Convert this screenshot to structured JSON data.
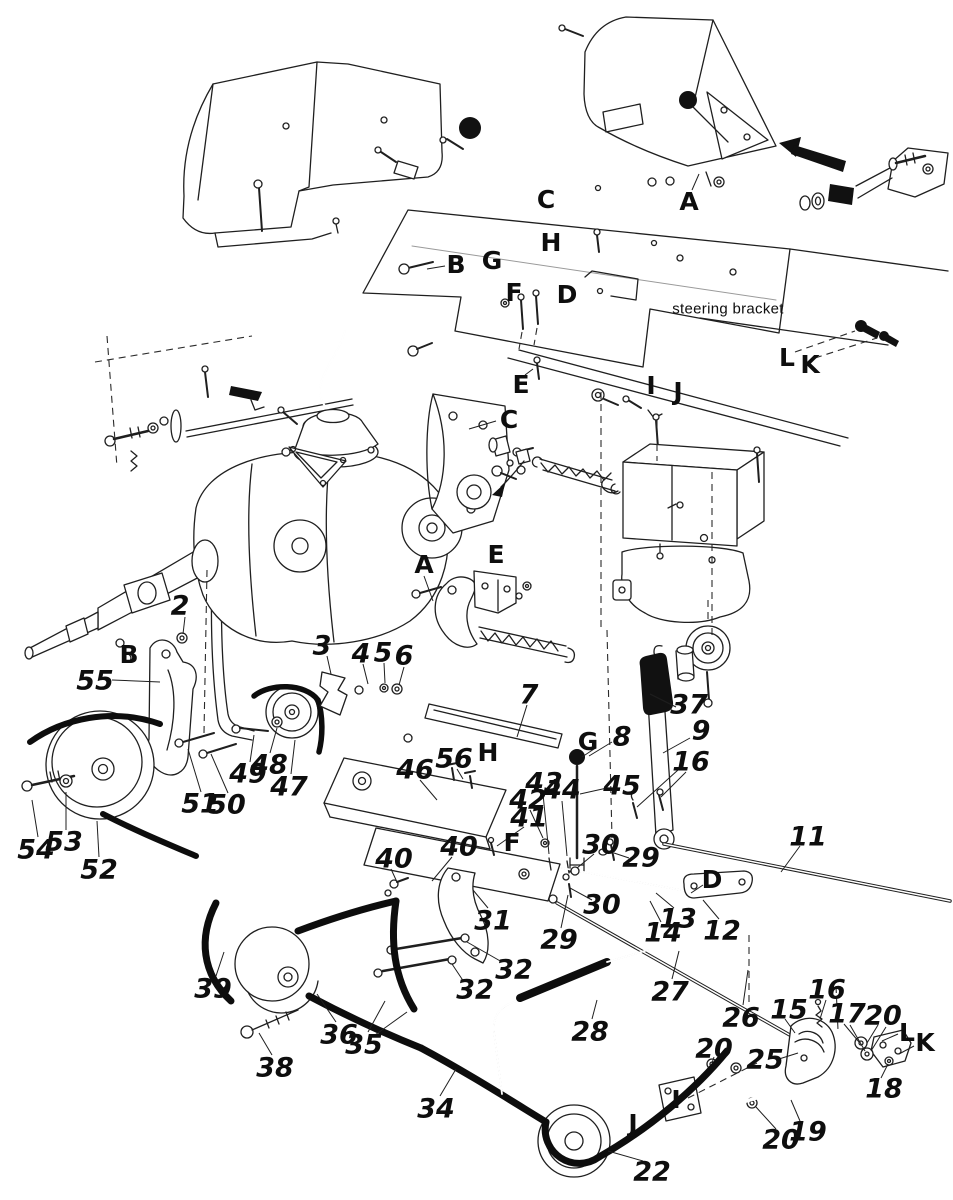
{
  "colors": {
    "ink": "#1f1f1f",
    "paper": "#ffffff",
    "solid_black": "#111111"
  },
  "note": {
    "steering_bracket": "steering bracket"
  },
  "labels": [
    {
      "id": "note-steering-bracket",
      "t": "steering bracket",
      "x": 728,
      "y": 308,
      "k": "note"
    },
    {
      "id": "ref-C-top",
      "t": "C",
      "x": 546,
      "y": 199,
      "k": "cap"
    },
    {
      "id": "ref-A-top",
      "t": "A",
      "x": 689,
      "y": 201,
      "k": "cap"
    },
    {
      "id": "ref-H-top",
      "t": "H",
      "x": 551,
      "y": 242,
      "k": "cap"
    },
    {
      "id": "ref-B-top",
      "t": "B",
      "x": 456,
      "y": 264,
      "k": "cap"
    },
    {
      "id": "ref-G-top",
      "t": "G",
      "x": 492,
      "y": 260,
      "k": "cap"
    },
    {
      "id": "ref-F-top",
      "t": "F",
      "x": 514,
      "y": 292,
      "k": "cap"
    },
    {
      "id": "ref-D-top",
      "t": "D",
      "x": 567,
      "y": 294,
      "k": "cap"
    },
    {
      "id": "ref-L-top",
      "t": "L",
      "x": 787,
      "y": 357,
      "k": "cap"
    },
    {
      "id": "ref-K-top",
      "t": "K",
      "x": 810,
      "y": 364,
      "k": "cap"
    },
    {
      "id": "ref-E-top",
      "t": "E",
      "x": 521,
      "y": 384,
      "k": "cap"
    },
    {
      "id": "ref-I-top",
      "t": "I",
      "x": 651,
      "y": 385,
      "k": "cap"
    },
    {
      "id": "ref-J-top",
      "t": "J",
      "x": 678,
      "y": 391,
      "k": "cap"
    },
    {
      "id": "ref-C-mid",
      "t": "C",
      "x": 509,
      "y": 419,
      "k": "cap"
    },
    {
      "id": "ref-E-mid",
      "t": "E",
      "x": 496,
      "y": 554,
      "k": "cap"
    },
    {
      "id": "ref-A-mid",
      "t": "A",
      "x": 424,
      "y": 564,
      "k": "cap"
    },
    {
      "id": "ref-B-left",
      "t": "B",
      "x": 129,
      "y": 654,
      "k": "cap"
    },
    {
      "id": "ref-G-mid",
      "t": "G",
      "x": 588,
      "y": 741,
      "k": "cap"
    },
    {
      "id": "ref-H-mid",
      "t": "H",
      "x": 488,
      "y": 752,
      "k": "cap"
    },
    {
      "id": "ref-F-mid",
      "t": "F",
      "x": 512,
      "y": 842,
      "k": "cap"
    },
    {
      "id": "ref-D-mid",
      "t": "D",
      "x": 712,
      "y": 879,
      "k": "cap"
    },
    {
      "id": "ref-L-bot",
      "t": "L",
      "x": 907,
      "y": 1032,
      "k": "cap"
    },
    {
      "id": "ref-K-bot",
      "t": "K",
      "x": 925,
      "y": 1042,
      "k": "cap"
    },
    {
      "id": "ref-I-bot",
      "t": "I",
      "x": 676,
      "y": 1099,
      "k": "cap"
    },
    {
      "id": "ref-J-bot",
      "t": "J",
      "x": 633,
      "y": 1123,
      "k": "cap"
    },
    {
      "id": "part-2",
      "t": "2",
      "x": 180,
      "y": 605,
      "k": "num"
    },
    {
      "id": "part-3",
      "t": "3",
      "x": 322,
      "y": 645,
      "k": "num"
    },
    {
      "id": "part-4",
      "t": "4",
      "x": 361,
      "y": 653,
      "k": "num"
    },
    {
      "id": "part-5",
      "t": "5",
      "x": 383,
      "y": 652,
      "k": "num"
    },
    {
      "id": "part-6",
      "t": "6",
      "x": 404,
      "y": 655,
      "k": "num"
    },
    {
      "id": "part-7",
      "t": "7",
      "x": 529,
      "y": 694,
      "k": "num"
    },
    {
      "id": "part-8",
      "t": "8",
      "x": 622,
      "y": 736,
      "k": "num"
    },
    {
      "id": "part-9",
      "t": "9",
      "x": 701,
      "y": 730,
      "k": "num"
    },
    {
      "id": "part-11",
      "t": "11",
      "x": 808,
      "y": 836,
      "k": "num"
    },
    {
      "id": "part-12",
      "t": "12",
      "x": 722,
      "y": 930,
      "k": "num"
    },
    {
      "id": "part-13",
      "t": "13",
      "x": 678,
      "y": 918,
      "k": "num"
    },
    {
      "id": "part-14",
      "t": "14",
      "x": 663,
      "y": 932,
      "k": "num"
    },
    {
      "id": "part-15",
      "t": "15",
      "x": 789,
      "y": 1009,
      "k": "num"
    },
    {
      "id": "part-16a",
      "t": "16",
      "x": 691,
      "y": 761,
      "k": "num"
    },
    {
      "id": "part-16b",
      "t": "16",
      "x": 827,
      "y": 989,
      "k": "num"
    },
    {
      "id": "part-17",
      "t": "17",
      "x": 847,
      "y": 1013,
      "k": "num"
    },
    {
      "id": "part-18",
      "t": "18",
      "x": 884,
      "y": 1088,
      "k": "num"
    },
    {
      "id": "part-19",
      "t": "19",
      "x": 808,
      "y": 1131,
      "k": "num"
    },
    {
      "id": "part-20a",
      "t": "20",
      "x": 883,
      "y": 1015,
      "k": "num"
    },
    {
      "id": "part-20b",
      "t": "20",
      "x": 714,
      "y": 1048,
      "k": "num"
    },
    {
      "id": "part-20c",
      "t": "20",
      "x": 781,
      "y": 1139,
      "k": "num"
    },
    {
      "id": "part-22",
      "t": "22",
      "x": 652,
      "y": 1171,
      "k": "num"
    },
    {
      "id": "part-25",
      "t": "25",
      "x": 765,
      "y": 1059,
      "k": "num"
    },
    {
      "id": "part-26",
      "t": "26",
      "x": 741,
      "y": 1017,
      "k": "num"
    },
    {
      "id": "part-27",
      "t": "27",
      "x": 670,
      "y": 991,
      "k": "num"
    },
    {
      "id": "part-28",
      "t": "28",
      "x": 590,
      "y": 1031,
      "k": "num"
    },
    {
      "id": "part-29a",
      "t": "29",
      "x": 641,
      "y": 857,
      "k": "num"
    },
    {
      "id": "part-29b",
      "t": "29",
      "x": 559,
      "y": 939,
      "k": "num"
    },
    {
      "id": "part-30a",
      "t": "30",
      "x": 601,
      "y": 844,
      "k": "num"
    },
    {
      "id": "part-30b",
      "t": "30",
      "x": 602,
      "y": 904,
      "k": "num"
    },
    {
      "id": "part-31",
      "t": "31",
      "x": 493,
      "y": 920,
      "k": "num"
    },
    {
      "id": "part-32a",
      "t": "32",
      "x": 514,
      "y": 969,
      "k": "num"
    },
    {
      "id": "part-32b",
      "t": "32",
      "x": 475,
      "y": 989,
      "k": "num"
    },
    {
      "id": "part-34",
      "t": "34",
      "x": 436,
      "y": 1108,
      "k": "num"
    },
    {
      "id": "part-35",
      "t": "35",
      "x": 364,
      "y": 1044,
      "k": "num"
    },
    {
      "id": "part-36",
      "t": "36",
      "x": 339,
      "y": 1034,
      "k": "num"
    },
    {
      "id": "part-37",
      "t": "37",
      "x": 689,
      "y": 704,
      "k": "num"
    },
    {
      "id": "part-38",
      "t": "38",
      "x": 275,
      "y": 1067,
      "k": "num"
    },
    {
      "id": "part-39",
      "t": "39",
      "x": 213,
      "y": 988,
      "k": "num"
    },
    {
      "id": "part-40a",
      "t": "40",
      "x": 459,
      "y": 846,
      "k": "num"
    },
    {
      "id": "part-40b",
      "t": "40",
      "x": 394,
      "y": 858,
      "k": "num"
    },
    {
      "id": "part-41",
      "t": "41",
      "x": 529,
      "y": 817,
      "k": "num"
    },
    {
      "id": "part-42",
      "t": "42",
      "x": 528,
      "y": 799,
      "k": "num"
    },
    {
      "id": "part-43",
      "t": "43",
      "x": 544,
      "y": 782,
      "k": "num"
    },
    {
      "id": "part-44",
      "t": "44",
      "x": 562,
      "y": 789,
      "k": "num"
    },
    {
      "id": "part-45",
      "t": "45",
      "x": 622,
      "y": 785,
      "k": "num"
    },
    {
      "id": "part-46",
      "t": "46",
      "x": 415,
      "y": 769,
      "k": "num"
    },
    {
      "id": "part-47",
      "t": "47",
      "x": 289,
      "y": 786,
      "k": "num"
    },
    {
      "id": "part-48",
      "t": "48",
      "x": 269,
      "y": 764,
      "k": "num"
    },
    {
      "id": "part-49",
      "t": "49",
      "x": 248,
      "y": 773,
      "k": "num"
    },
    {
      "id": "part-50",
      "t": "50",
      "x": 227,
      "y": 804,
      "k": "num"
    },
    {
      "id": "part-51",
      "t": "51",
      "x": 200,
      "y": 803,
      "k": "num"
    },
    {
      "id": "part-52",
      "t": "52",
      "x": 99,
      "y": 869,
      "k": "num"
    },
    {
      "id": "part-53",
      "t": "53",
      "x": 64,
      "y": 841,
      "k": "num"
    },
    {
      "id": "part-54",
      "t": "54",
      "x": 36,
      "y": 849,
      "k": "num"
    },
    {
      "id": "part-55",
      "t": "55",
      "x": 95,
      "y": 680,
      "k": "num"
    },
    {
      "id": "part-56",
      "t": "56",
      "x": 454,
      "y": 758,
      "k": "num"
    }
  ],
  "leaders": [
    [
      112,
      680,
      160,
      682
    ],
    [
      185,
      617,
      183,
      634
    ],
    [
      327,
      656,
      331,
      674
    ],
    [
      363,
      664,
      368,
      684
    ],
    [
      384,
      663,
      385,
      683
    ],
    [
      404,
      667,
      399,
      685
    ],
    [
      527,
      705,
      517,
      737
    ],
    [
      612,
      742,
      589,
      756
    ],
    [
      594,
      749,
      582,
      757
    ],
    [
      690,
      738,
      663,
      753
    ],
    [
      676,
      707,
      650,
      694
    ],
    [
      678,
      770,
      637,
      807
    ],
    [
      686,
      772,
      661,
      797
    ],
    [
      607,
      788,
      580,
      794
    ],
    [
      543,
      794,
      549,
      854
    ],
    [
      562,
      801,
      567,
      856
    ],
    [
      530,
      810,
      543,
      838
    ],
    [
      524,
      827,
      497,
      846
    ],
    [
      452,
      857,
      432,
      881
    ],
    [
      391,
      869,
      397,
      882
    ],
    [
      420,
      780,
      437,
      800
    ],
    [
      457,
      769,
      463,
      779
    ],
    [
      291,
      774,
      295,
      740
    ],
    [
      270,
      753,
      277,
      728
    ],
    [
      250,
      762,
      254,
      735
    ],
    [
      228,
      793,
      211,
      754
    ],
    [
      201,
      792,
      188,
      749
    ],
    [
      99,
      857,
      97,
      821
    ],
    [
      66,
      830,
      66,
      792
    ],
    [
      38,
      837,
      32,
      800
    ],
    [
      272,
      1055,
      259,
      1033
    ],
    [
      216,
      976,
      224,
      952
    ],
    [
      336,
      1022,
      317,
      994
    ],
    [
      368,
      1032,
      385,
      1001
    ],
    [
      375,
      1035,
      407,
      1012
    ],
    [
      440,
      1096,
      456,
      1069
    ],
    [
      643,
      1161,
      608,
      1151
    ],
    [
      592,
      1019,
      597,
      1000
    ],
    [
      672,
      979,
      679,
      951
    ],
    [
      743,
      1005,
      748,
      970
    ],
    [
      488,
      908,
      473,
      890
    ],
    [
      502,
      962,
      467,
      942
    ],
    [
      464,
      982,
      452,
      964
    ],
    [
      594,
      854,
      577,
      868
    ],
    [
      592,
      900,
      570,
      888
    ],
    [
      629,
      858,
      614,
      853
    ],
    [
      561,
      928,
      568,
      895
    ],
    [
      661,
      922,
      650,
      901
    ],
    [
      674,
      908,
      656,
      893
    ],
    [
      719,
      919,
      703,
      900
    ],
    [
      703,
      885,
      691,
      893
    ],
    [
      800,
      846,
      781,
      872
    ],
    [
      785,
      1019,
      795,
      1033
    ],
    [
      826,
      1000,
      820,
      1019
    ],
    [
      844,
      1024,
      859,
      1042
    ],
    [
      850,
      1025,
      865,
      1051
    ],
    [
      878,
      1025,
      867,
      1043
    ],
    [
      886,
      1027,
      871,
      1051
    ],
    [
      779,
      1059,
      798,
      1053
    ],
    [
      881,
      1078,
      888,
      1064
    ],
    [
      800,
      1121,
      791,
      1100
    ],
    [
      776,
      1129,
      756,
      1107
    ],
    [
      714,
      1057,
      712,
      1063
    ],
    [
      424,
      576,
      433,
      601
    ],
    [
      496,
      421,
      469,
      429
    ],
    [
      692,
      190,
      699,
      174
    ],
    [
      445,
      266,
      427,
      269
    ],
    [
      525,
      375,
      533,
      369
    ],
    [
      898,
      1034,
      882,
      1041
    ],
    [
      914,
      1046,
      899,
      1054
    ]
  ],
  "dashed": [
    [
      795,
      352,
      855,
      331
    ],
    [
      815,
      358,
      877,
      338
    ],
    [
      522,
      332,
      519,
      349
    ],
    [
      537,
      328,
      534,
      345
    ],
    [
      601,
      392,
      601,
      630
    ],
    [
      607,
      630,
      612,
      838
    ],
    [
      657,
      420,
      657,
      461
    ],
    [
      712,
      472,
      712,
      637
    ],
    [
      836,
      986,
      838,
      1030
    ],
    [
      688,
      1098,
      757,
      1063
    ],
    [
      749,
      935,
      749,
      1006
    ],
    [
      107,
      336,
      117,
      467
    ],
    [
      95,
      362,
      252,
      336
    ],
    [
      708,
      600,
      708,
      624
    ],
    [
      207,
      570,
      204,
      733
    ]
  ]
}
